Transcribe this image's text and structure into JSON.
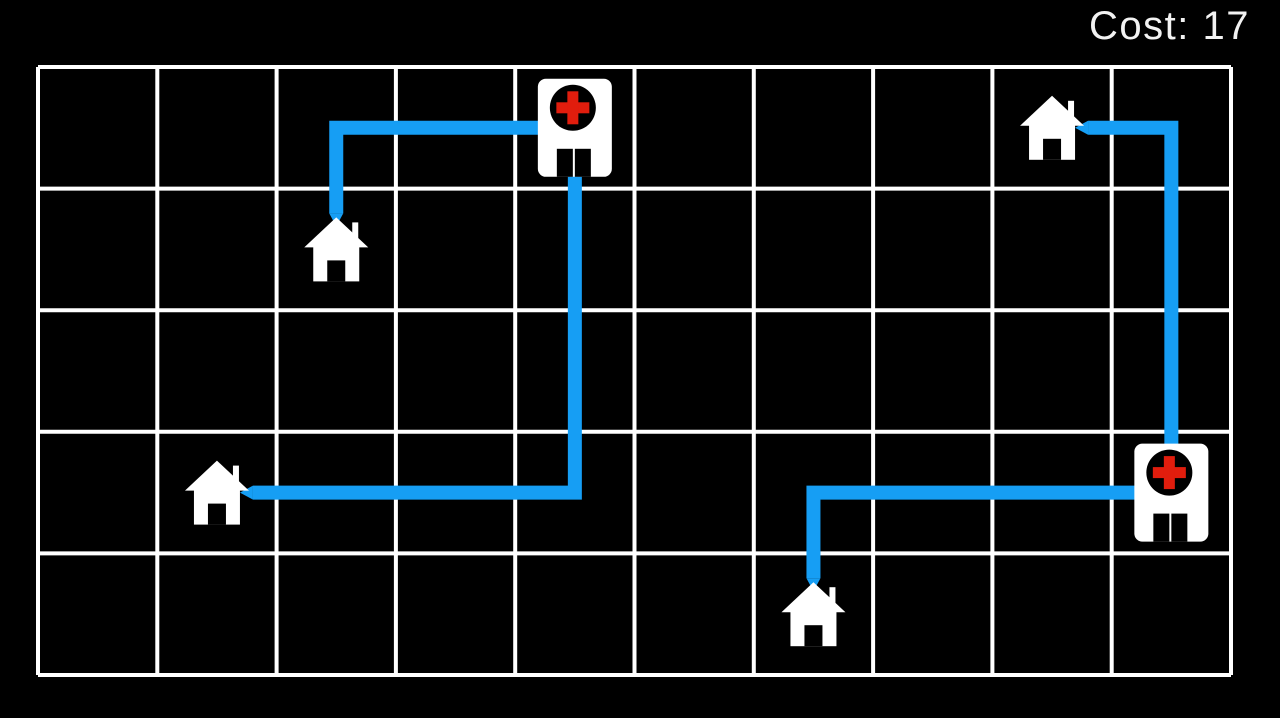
{
  "hud": {
    "cost_label": "Cost: 17",
    "cost_value": 17
  },
  "board": {
    "cols": 10,
    "rows": 5,
    "hospitals": [
      {
        "id": "hospital-1",
        "cell": [
          4,
          0
        ]
      },
      {
        "id": "hospital-2",
        "cell": [
          9,
          3
        ]
      }
    ],
    "houses": [
      {
        "id": "house-1",
        "cell": [
          2,
          1
        ]
      },
      {
        "id": "house-2",
        "cell": [
          1,
          3
        ]
      },
      {
        "id": "house-3",
        "cell": [
          8,
          0
        ]
      },
      {
        "id": "house-4",
        "cell": [
          6,
          4
        ]
      }
    ],
    "routes": [
      {
        "from": "hospital-1",
        "to": "house-1",
        "cells": [
          [
            4,
            0
          ],
          [
            2,
            0
          ],
          [
            2,
            1
          ]
        ]
      },
      {
        "from": "hospital-1",
        "to": "house-2",
        "cells": [
          [
            4,
            0
          ],
          [
            4,
            3
          ],
          [
            1,
            3
          ]
        ]
      },
      {
        "from": "hospital-2",
        "to": "house-3",
        "cells": [
          [
            9,
            3
          ],
          [
            9,
            0
          ],
          [
            8,
            0
          ]
        ]
      },
      {
        "from": "hospital-2",
        "to": "house-4",
        "cells": [
          [
            9,
            3
          ],
          [
            6,
            3
          ],
          [
            6,
            4
          ]
        ]
      }
    ]
  },
  "colors": {
    "background": "#000000",
    "grid_line": "#ffffff",
    "route": "#169ef4",
    "building_white": "#ffffff",
    "building_black": "#000000",
    "cross_red": "#e11d0d",
    "hud_text": "#f2f2f2"
  }
}
